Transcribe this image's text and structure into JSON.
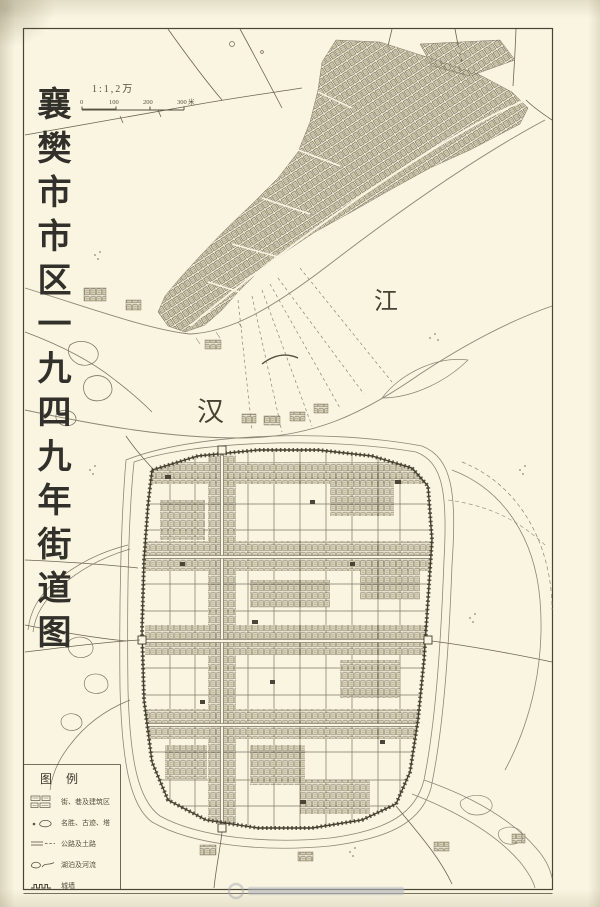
{
  "map": {
    "title_vertical": "襄樊市市区一九四九年街道图",
    "river_labels": {
      "han": "汉",
      "jiang": "江"
    }
  },
  "scale": {
    "ratio_label": "1:1,2万",
    "ticks": [
      "0",
      "100",
      "200",
      "300"
    ],
    "unit": "米"
  },
  "legend": {
    "title": "图例",
    "items": [
      {
        "icon": "building-blocks-symbol",
        "label": "街、巷及建筑区"
      },
      {
        "icon": "landmark-pond-symbol",
        "label": "名胜、古迹、塔"
      },
      {
        "icon": "road-symbol",
        "label": "公路及土路"
      },
      {
        "icon": "lake-river-symbol",
        "label": "湖泊及河流"
      },
      {
        "icon": "city-wall-symbol",
        "label": "城墙"
      }
    ]
  },
  "colors": {
    "paper": "#f9f5e0",
    "ink_dark": "#3f3a2c",
    "ink_mid": "#6b6452",
    "ink_light": "#8d8775"
  }
}
